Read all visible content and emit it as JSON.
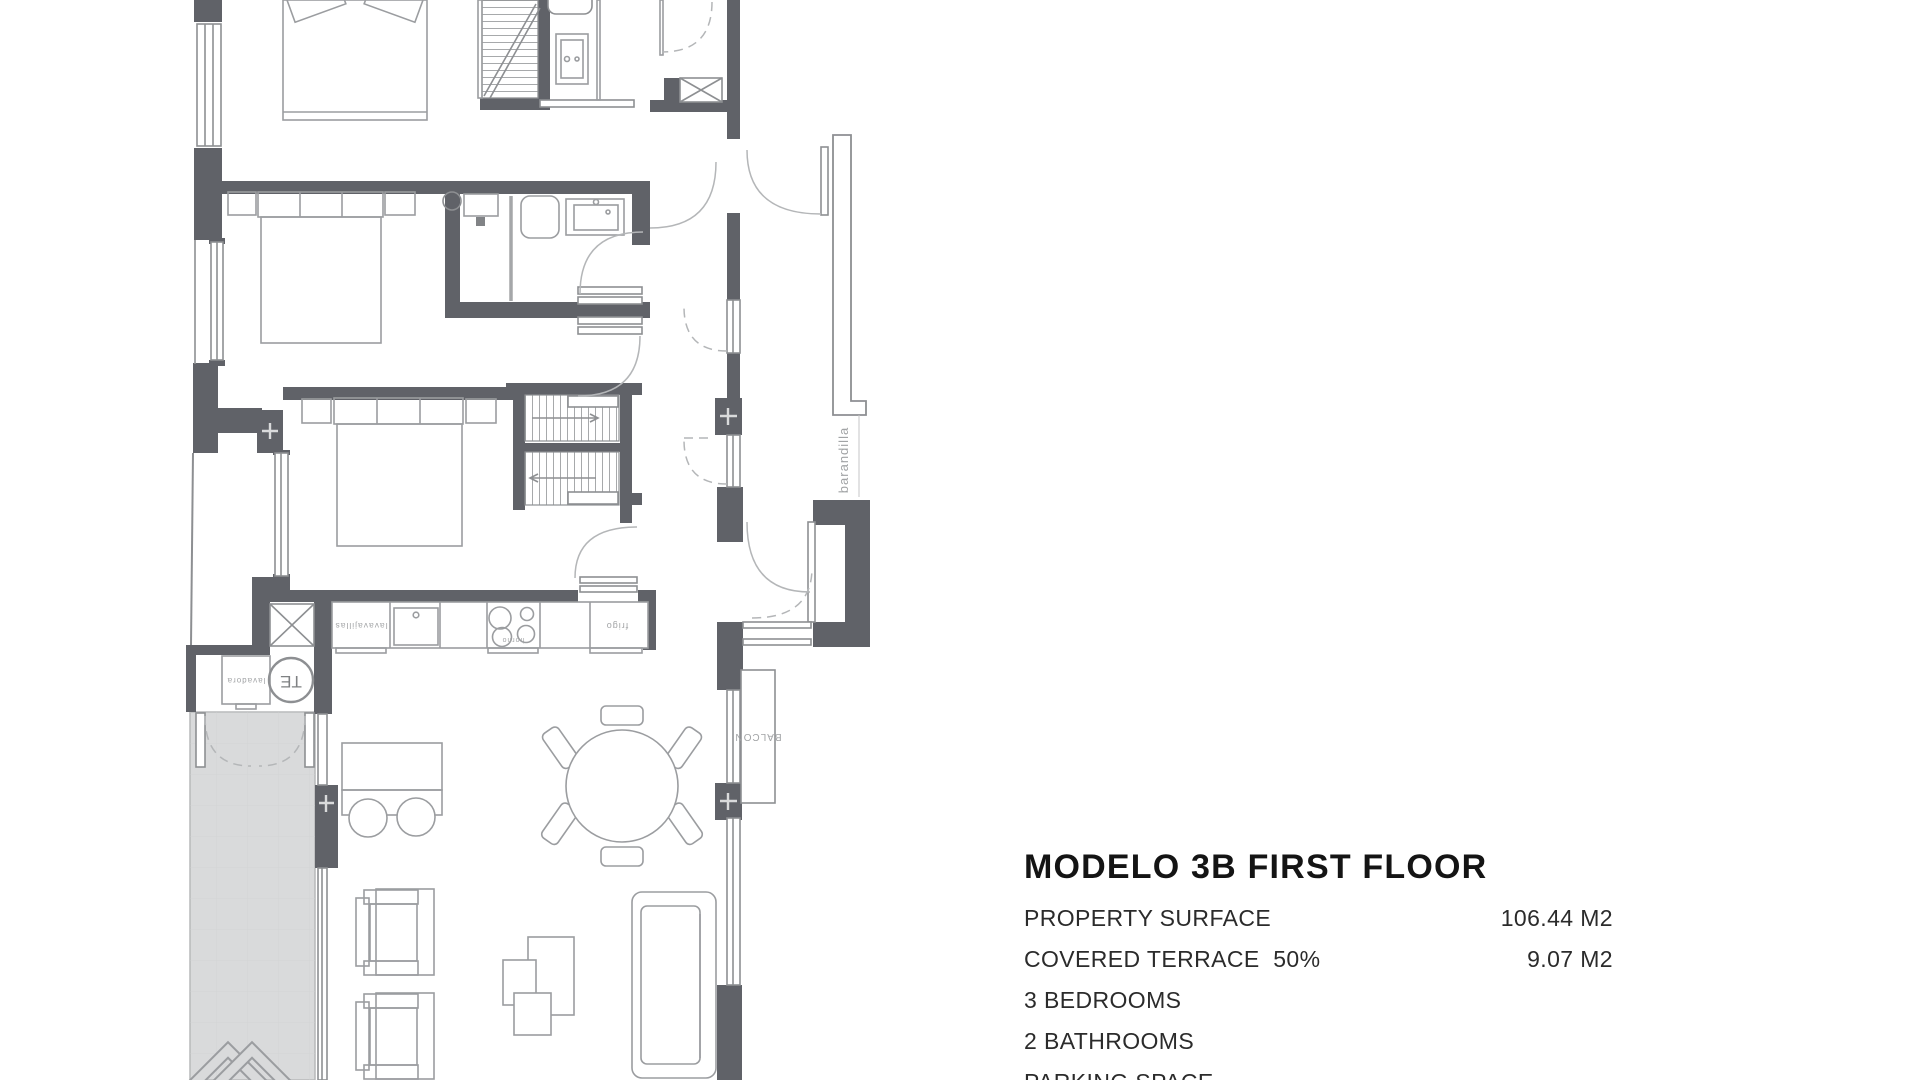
{
  "info_panel": {
    "title": "MODELO 3B FIRST FLOOR",
    "rows": [
      {
        "label": "PROPERTY SURFACE",
        "value": "106.44 M2"
      },
      {
        "label": "COVERED TERRACE  50%",
        "value": "9.07 M2"
      },
      {
        "label": "3 BEDROOMS",
        "value": ""
      },
      {
        "label": "2 BATHROOMS",
        "value": ""
      },
      {
        "label": "PARKING SPACE",
        "value": ""
      }
    ]
  },
  "floor_plan": {
    "labels": {
      "railing": "barandilla",
      "balcony": "BALCON",
      "water_heater": "TE",
      "washing_machine": "lavadora",
      "dishwasher": "lavavajillas",
      "fridge": "frigo",
      "oven": "horno"
    },
    "colors": {
      "wall": "#606268",
      "terrace_fill": "#d9dadb",
      "furniture_stroke": "#9b9da0",
      "fixture_stroke": "#8d8f92",
      "label_text": "#a2a4a6"
    }
  }
}
